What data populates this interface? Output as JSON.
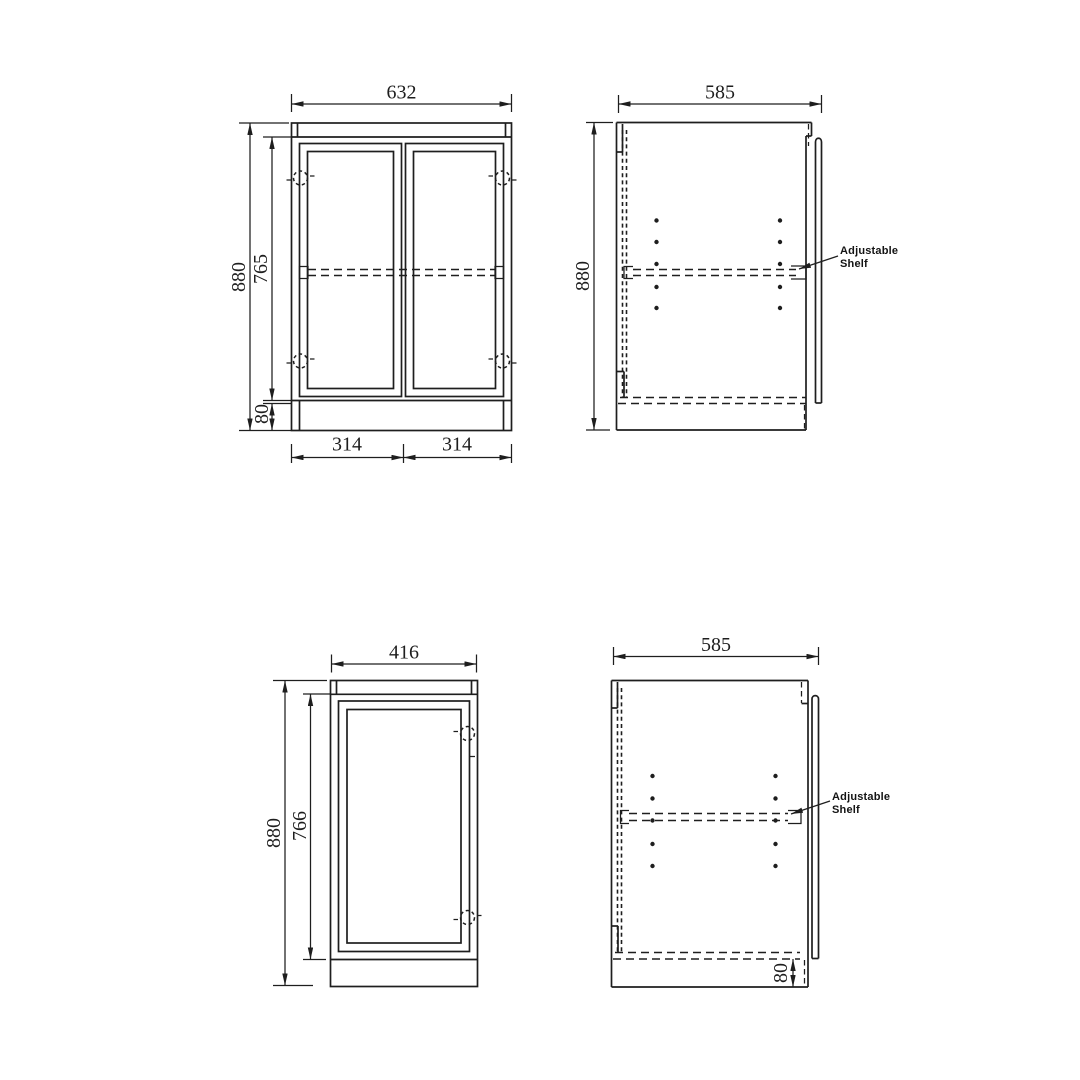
{
  "colors": {
    "line": "#1e1e1e",
    "background": "#ffffff"
  },
  "views": {
    "front_double": {
      "width": "632",
      "height": "880",
      "door_height": "765",
      "plinth_height": "80",
      "left_door_width": "314",
      "right_door_width": "314"
    },
    "side_upper": {
      "depth": "585",
      "height": "880",
      "shelf_label_line1": "Adjustable",
      "shelf_label_line2": "Shelf"
    },
    "front_single": {
      "width": "416",
      "height": "880",
      "door_height": "766"
    },
    "side_lower": {
      "depth": "585",
      "plinth_height": "80",
      "shelf_label_line1": "Adjustable",
      "shelf_label_line2": "Shelf"
    }
  }
}
